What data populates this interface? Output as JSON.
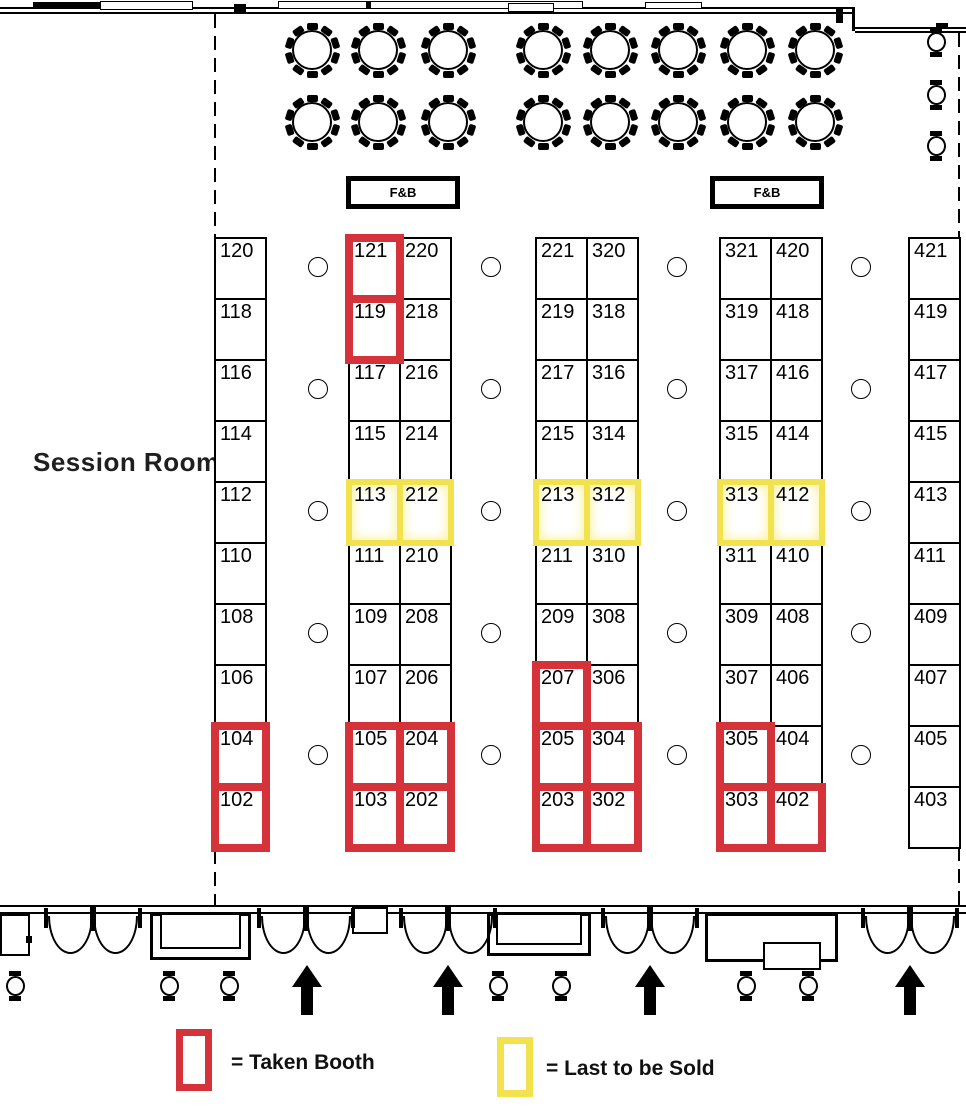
{
  "labels": {
    "session_room": "Session Room",
    "fnb": "F&B"
  },
  "legend": {
    "taken": "= Taken Booth",
    "last": "= Last to be Sold"
  },
  "colors": {
    "taken": "#d5323a",
    "last": "#f2e24d",
    "wall": "#000000"
  },
  "summary": {
    "taken_booths": [
      "121",
      "119",
      "104",
      "102",
      "105",
      "103",
      "204",
      "202",
      "207",
      "205",
      "203",
      "304",
      "302",
      "305",
      "303",
      "402"
    ],
    "last_to_be_sold": [
      "113",
      "212",
      "213",
      "312",
      "313",
      "412"
    ]
  },
  "booths": {
    "top": 237,
    "row_h": 61,
    "cell_w": 53,
    "columns": [
      {
        "name": "row-100-left",
        "x": 214,
        "cols": 1,
        "cells": [
          {
            "n": "120",
            "s": "open"
          },
          {
            "n": "118",
            "s": "open"
          },
          {
            "n": "116",
            "s": "open"
          },
          {
            "n": "114",
            "s": "open"
          },
          {
            "n": "112",
            "s": "open"
          },
          {
            "n": "110",
            "s": "open"
          },
          {
            "n": "108",
            "s": "open"
          },
          {
            "n": "106",
            "s": "open"
          },
          {
            "n": "104",
            "s": "taken"
          },
          {
            "n": "102",
            "s": "taken"
          }
        ]
      },
      {
        "name": "row-100-200",
        "x": 348,
        "cols": 2,
        "cells": [
          {
            "n": "121",
            "s": "taken"
          },
          {
            "n": "220",
            "s": "open"
          },
          {
            "n": "119",
            "s": "taken"
          },
          {
            "n": "218",
            "s": "open"
          },
          {
            "n": "117",
            "s": "open"
          },
          {
            "n": "216",
            "s": "open"
          },
          {
            "n": "115",
            "s": "open"
          },
          {
            "n": "214",
            "s": "open"
          },
          {
            "n": "113",
            "s": "last"
          },
          {
            "n": "212",
            "s": "last"
          },
          {
            "n": "111",
            "s": "open"
          },
          {
            "n": "210",
            "s": "open"
          },
          {
            "n": "109",
            "s": "open"
          },
          {
            "n": "208",
            "s": "open"
          },
          {
            "n": "107",
            "s": "open"
          },
          {
            "n": "206",
            "s": "open"
          },
          {
            "n": "105",
            "s": "taken"
          },
          {
            "n": "204",
            "s": "taken"
          },
          {
            "n": "103",
            "s": "taken"
          },
          {
            "n": "202",
            "s": "taken"
          }
        ]
      },
      {
        "name": "row-200-300",
        "x": 535,
        "cols": 2,
        "cells": [
          {
            "n": "221",
            "s": "open"
          },
          {
            "n": "320",
            "s": "open"
          },
          {
            "n": "219",
            "s": "open"
          },
          {
            "n": "318",
            "s": "open"
          },
          {
            "n": "217",
            "s": "open"
          },
          {
            "n": "316",
            "s": "open"
          },
          {
            "n": "215",
            "s": "open"
          },
          {
            "n": "314",
            "s": "open"
          },
          {
            "n": "213",
            "s": "last"
          },
          {
            "n": "312",
            "s": "last"
          },
          {
            "n": "211",
            "s": "open"
          },
          {
            "n": "310",
            "s": "open"
          },
          {
            "n": "209",
            "s": "open"
          },
          {
            "n": "308",
            "s": "open"
          },
          {
            "n": "207",
            "s": "taken"
          },
          {
            "n": "306",
            "s": "open"
          },
          {
            "n": "205",
            "s": "taken"
          },
          {
            "n": "304",
            "s": "taken"
          },
          {
            "n": "203",
            "s": "taken"
          },
          {
            "n": "302",
            "s": "taken"
          }
        ]
      },
      {
        "name": "row-300-400",
        "x": 719,
        "cols": 2,
        "cells": [
          {
            "n": "321",
            "s": "open"
          },
          {
            "n": "420",
            "s": "open"
          },
          {
            "n": "319",
            "s": "open"
          },
          {
            "n": "418",
            "s": "open"
          },
          {
            "n": "317",
            "s": "open"
          },
          {
            "n": "416",
            "s": "open"
          },
          {
            "n": "315",
            "s": "open"
          },
          {
            "n": "414",
            "s": "open"
          },
          {
            "n": "313",
            "s": "last"
          },
          {
            "n": "412",
            "s": "last"
          },
          {
            "n": "311",
            "s": "open"
          },
          {
            "n": "410",
            "s": "open"
          },
          {
            "n": "309",
            "s": "open"
          },
          {
            "n": "408",
            "s": "open"
          },
          {
            "n": "307",
            "s": "open"
          },
          {
            "n": "406",
            "s": "open"
          },
          {
            "n": "305",
            "s": "taken"
          },
          {
            "n": "404",
            "s": "open"
          },
          {
            "n": "303",
            "s": "taken"
          },
          {
            "n": "402",
            "s": "taken"
          }
        ]
      },
      {
        "name": "row-400-right",
        "x": 908,
        "cols": 1,
        "cells": [
          {
            "n": "421",
            "s": "open"
          },
          {
            "n": "419",
            "s": "open"
          },
          {
            "n": "417",
            "s": "open"
          },
          {
            "n": "415",
            "s": "open"
          },
          {
            "n": "413",
            "s": "open"
          },
          {
            "n": "411",
            "s": "open"
          },
          {
            "n": "409",
            "s": "open"
          },
          {
            "n": "407",
            "s": "open"
          },
          {
            "n": "405",
            "s": "open"
          },
          {
            "n": "403",
            "s": "open"
          }
        ]
      }
    ]
  },
  "tables": {
    "xs": [
      312,
      378,
      448,
      543,
      610,
      678,
      747,
      815
    ],
    "ys": [
      50,
      122
    ],
    "seats_per_table": 10
  },
  "pillars": {
    "xs": [
      318,
      491,
      677,
      861
    ],
    "ys": [
      267,
      389,
      511,
      633,
      755
    ]
  },
  "chairs": {
    "right": [
      [
        936,
        42
      ],
      [
        936,
        95
      ],
      [
        936,
        146
      ]
    ],
    "bottom": [
      [
        15,
        986
      ],
      [
        169,
        986
      ],
      [
        229,
        986
      ],
      [
        498,
        986
      ],
      [
        561,
        986
      ],
      [
        746,
        986
      ],
      [
        808,
        986
      ]
    ]
  },
  "doors": {
    "centers": [
      93,
      306,
      448,
      650,
      910
    ]
  },
  "arrows": {
    "xs": [
      307,
      448,
      650,
      910
    ]
  }
}
